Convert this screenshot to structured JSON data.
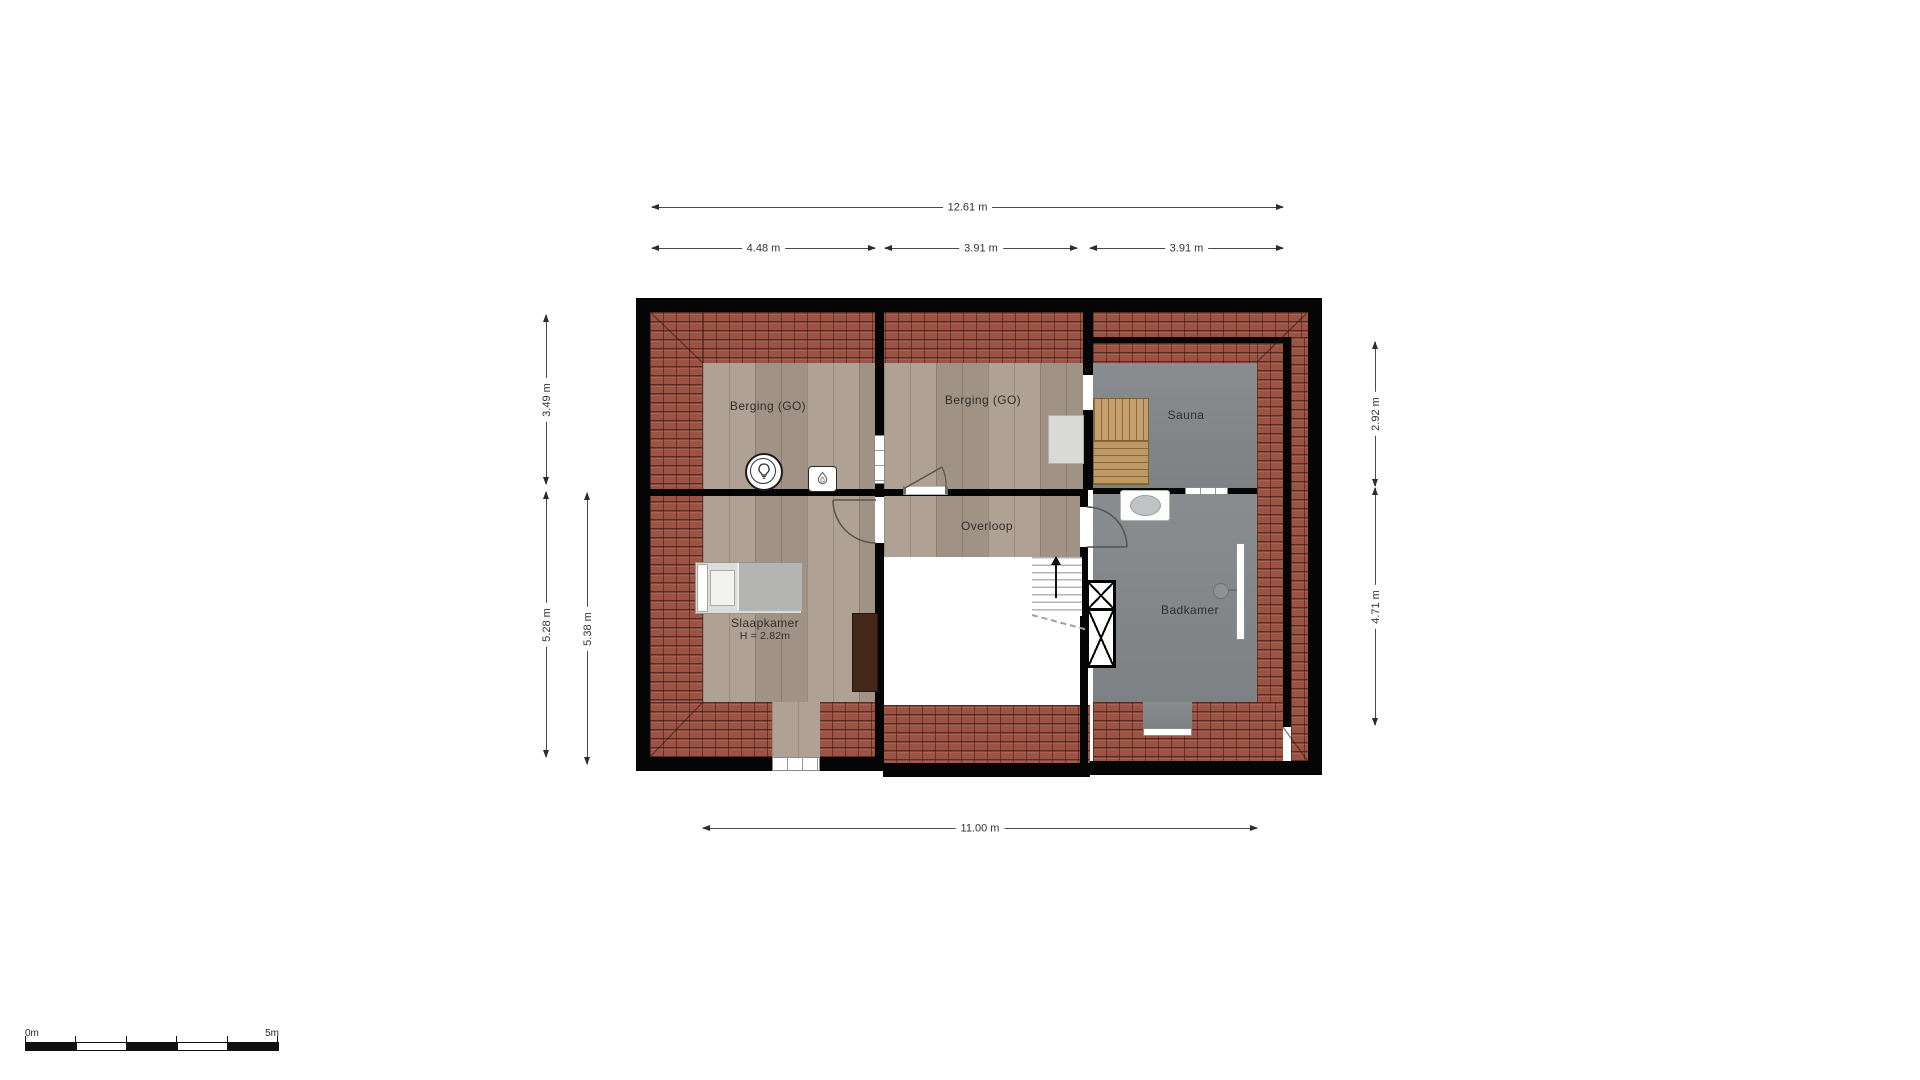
{
  "floor_plan": {
    "type": "attic floor plan",
    "rooms": [
      {
        "id": "berging-left",
        "label": "Berging (GO)"
      },
      {
        "id": "berging-middle",
        "label": "Berging (GO)"
      },
      {
        "id": "sauna",
        "label": "Sauna"
      },
      {
        "id": "overloop",
        "label": "Overloop"
      },
      {
        "id": "slaapkamer",
        "label": "Slaapkamer",
        "height_note": "H = 2.82m"
      },
      {
        "id": "badkamer",
        "label": "Badkamer"
      }
    ],
    "dimensions": {
      "overall_width": "12.61 m",
      "top_segment_1": "4.48 m",
      "top_segment_2": "3.91 m",
      "top_segment_3": "3.91 m",
      "left_top": "3.49 m",
      "left_bottom_outer": "5.28 m",
      "left_bottom_inner": "5.38 m",
      "right_top": "2.92 m",
      "right_bottom": "4.71 m",
      "bottom_width": "11.00 m"
    },
    "scale_bar": {
      "start_label": "0m",
      "end_label": "5m",
      "meters": 5
    },
    "colors": {
      "wall": "#050505",
      "roof_tiles": "#9c5343",
      "wood_floor": "#a99b8c",
      "wet_room_floor": "#85888b",
      "bench_wood": "#c4a06f",
      "stairwell": "#ffffff"
    }
  }
}
